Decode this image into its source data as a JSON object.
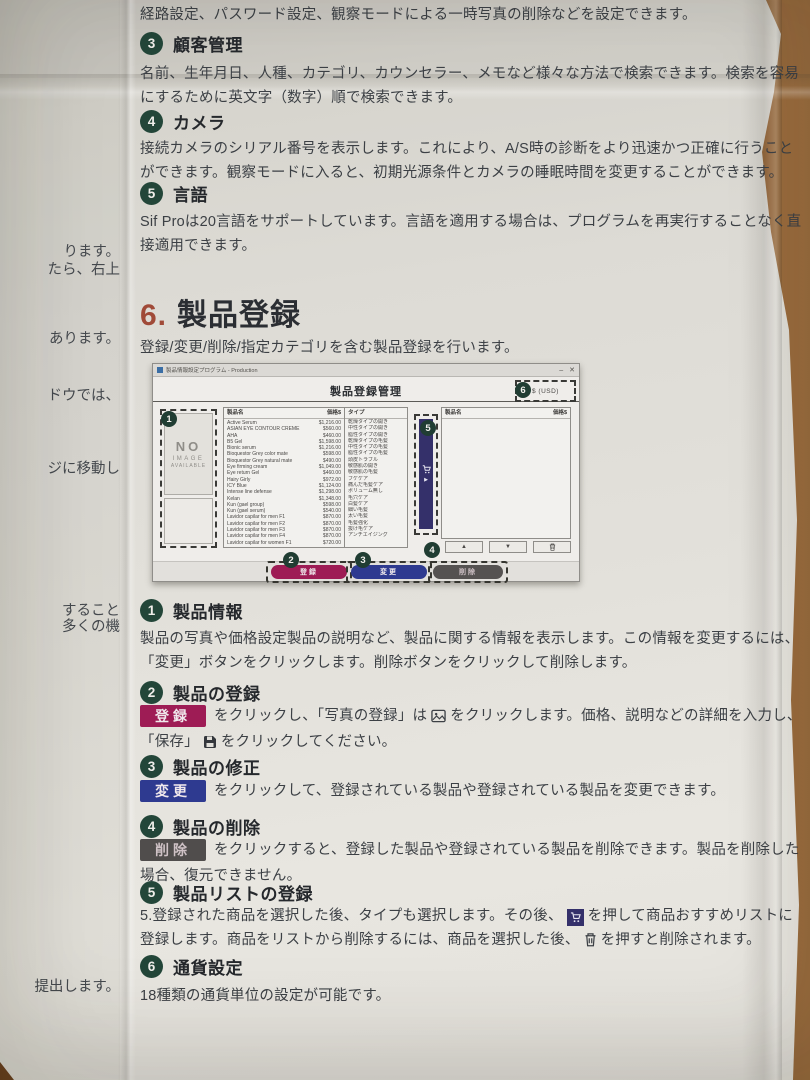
{
  "page": {
    "intro": "経路設定、パスワード設定、観察モードによる一時写真の削除などを設定できます。",
    "sections_top": [
      {
        "num": "3",
        "title": "顧客管理",
        "body": "名前、生年月日、人種、カテゴリ、カウンセラー、メモなど様々な方法で検索できます。検索を容易にするために英文字（数字）順で検索できます。"
      },
      {
        "num": "4",
        "title": "カメラ",
        "body": "接続カメラのシリアル番号を表示します。これにより、A/S時の診断をより迅速かつ正確に行うことができます。観察モードに入ると、初期光源条件とカメラの睡眠時間を変更することができます。"
      },
      {
        "num": "5",
        "title": "言語",
        "body": "Sif Proは20言語をサポートしています。言語を適用する場合は、プログラムを再実行することなく直接適用できます。"
      }
    ],
    "chapter_number": "6.",
    "chapter_title": "製品登録",
    "chapter_subtitle": "登録/変更/削除/指定カテゴリを含む製品登録を行います。",
    "margin_fragments": [
      "ります。",
      "たら、右上",
      "あります。",
      "ドウでは、",
      "ジに移動し",
      "すること",
      "多くの機",
      "提出します。"
    ]
  },
  "window": {
    "titlebar_title": "製品情報設定プログラム - Production",
    "minimize": "–",
    "close": "✕",
    "header_title": "製品登録管理",
    "currency_label": "$ (USD)",
    "no_image_l1": "NO",
    "no_image_l2": "IMAGE",
    "no_image_l3": "AVAILABLE",
    "columns": {
      "name": "製品名",
      "price": "価格$",
      "type": "タイプ"
    },
    "products": [
      {
        "name": "Active Serum",
        "price": "$1,216.00",
        "type": "乾燥タイプの開き"
      },
      {
        "name": "ASIAN EYE CONTOUR CREME",
        "price": "$560.00",
        "type": "中性タイプの開き"
      },
      {
        "name": "AHA",
        "price": "$460.00",
        "type": "脂性タイプの開き"
      },
      {
        "name": "B5 Gel",
        "price": "$1,598.00",
        "type": "乾燥タイプの毛髪"
      },
      {
        "name": "Bionic serum",
        "price": "$1,216.00",
        "type": "中性タイプの毛髪"
      },
      {
        "name": "Bioquestor Grey color mate",
        "price": "$598.00",
        "type": "脂性タイプの毛髪"
      },
      {
        "name": "Bioquestor Grey natural mate",
        "price": "$490.00",
        "type": "頭皮トラブル"
      },
      {
        "name": "Eye firming cream",
        "price": "$1,049.00",
        "type": "敏感肌の開き"
      },
      {
        "name": "Eye return Gel",
        "price": "$460.00",
        "type": "敏感肌の毛髪"
      },
      {
        "name": "Hairy Girly",
        "price": "$972.00",
        "type": "フケケア"
      },
      {
        "name": "ICY Blue",
        "price": "$1,124.00",
        "type": "痛んだ毛髪ケア"
      },
      {
        "name": "Intense line defense",
        "price": "$1,298.00",
        "type": "ボリューム無し"
      },
      {
        "name": "Kelan",
        "price": "$1,348.00",
        "type": "毛穴ケア"
      },
      {
        "name": "Kun (gael group)",
        "price": "$598.00",
        "type": "白髪ケア"
      },
      {
        "name": "Kun (gael serum)",
        "price": "$540.00",
        "type": "細い毛髪"
      },
      {
        "name": "Lavidor capilar for men F1",
        "price": "$870.00",
        "type": "太い毛髪"
      },
      {
        "name": "Lavidor capilar for men F2",
        "price": "$870.00",
        "type": "毛髪強化"
      },
      {
        "name": "Lavidor capilar for men F3",
        "price": "$870.00",
        "type": "抜け毛ケア"
      },
      {
        "name": "Lavidor capilar for men F4",
        "price": "$870.00",
        "type": "アンチエイジング"
      },
      {
        "name": "Lavidor capilar for women F1",
        "price": "$720.00",
        "type": ""
      }
    ],
    "controls": {
      "up": "▲",
      "down": "▼"
    },
    "play": "▶",
    "action_buttons": {
      "register": "登録",
      "modify": "変更",
      "delete": "削除"
    },
    "badges": {
      "b1": "1",
      "b2": "2",
      "b3": "3",
      "b4": "4",
      "b5": "5",
      "b6": "6"
    }
  },
  "sections_bottom": {
    "s1": {
      "num": "1",
      "title": "製品情報",
      "body": "製品の写真や価格設定製品の説明など、製品に関する情報を表示します。この情報を変更するには、「変更」ボタンをクリックします。削除ボタンをクリックして削除します。"
    },
    "s2": {
      "num": "2",
      "title": "製品の登録",
      "btn": "登録",
      "t1": "をクリックし、「写真の登録」は",
      "t2": "をクリックします。価格、説明などの詳細を入力し、",
      "t3": "「保存」",
      "t4": "をクリックしてください。"
    },
    "s3": {
      "num": "3",
      "title": "製品の修正",
      "btn": "変更",
      "t1": "をクリックして、登録されている製品や登録されている製品を変更できます。"
    },
    "s4": {
      "num": "4",
      "title": "製品の削除",
      "btn": "削除",
      "t1": "をクリックすると、登録した製品や登録されている製品を削除できます。製品を削除した場合、復元できません。"
    },
    "s5": {
      "num": "5",
      "title": "製品リストの登録",
      "t1": "5.登録された商品を選択した後、タイプも選択します。その後、",
      "t2": "を押して商品おすすめリストに登録します。商品をリストから削除するには、商品を選択した後、",
      "t3": "を押すと削除されます。"
    },
    "s6": {
      "num": "6",
      "title": "通貨設定",
      "body": "18種類の通貨単位の設定が可能です。"
    }
  },
  "colors": {
    "badge": "#234639",
    "register": "#9e1c55",
    "modify": "#2e3a90",
    "delete": "#504d4c",
    "chapter_num": "#a04a38"
  }
}
